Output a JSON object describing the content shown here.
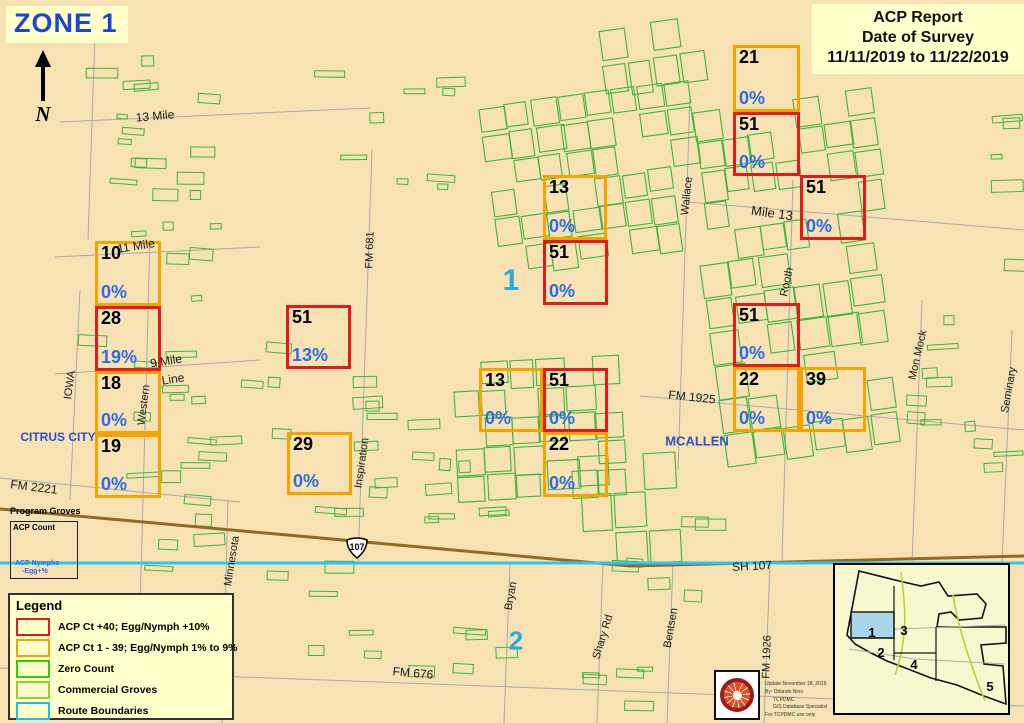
{
  "colors": {
    "map_bg": "#F7E2B4",
    "panel_bg": "#FFFFCC",
    "high": "#E31A1C",
    "moderate": "#F5A300",
    "pct_text": "#2E6BE6",
    "zone_title": "#1C46D0",
    "zone_marker": "#29ABE2",
    "city_text": "#2E50C8",
    "grove_green": "#3DB53D",
    "route_cyan": "#2BC7EF",
    "highway_brown": "#8F6B2A",
    "road_gray": "#A9A9A9"
  },
  "header": {
    "zone_title": "ZONE 1",
    "north_label": "N"
  },
  "report_box": {
    "lines": [
      "ACP Report",
      "Date of Survey",
      "11/11/2019 to 11/22/2019"
    ]
  },
  "squares": [
    {
      "count": "10",
      "pct": "0%",
      "severity": "moderate",
      "x": 95,
      "y": 241,
      "w": 66,
      "h": 65
    },
    {
      "count": "28",
      "pct": "19%",
      "severity": "high",
      "x": 95,
      "y": 306,
      "w": 66,
      "h": 65
    },
    {
      "count": "18",
      "pct": "0%",
      "severity": "moderate",
      "x": 95,
      "y": 371,
      "w": 66,
      "h": 63
    },
    {
      "count": "19",
      "pct": "0%",
      "severity": "moderate",
      "x": 95,
      "y": 434,
      "w": 66,
      "h": 64
    },
    {
      "count": "51",
      "pct": "13%",
      "severity": "high",
      "x": 286,
      "y": 305,
      "w": 65,
      "h": 64
    },
    {
      "count": "29",
      "pct": "0%",
      "severity": "moderate",
      "x": 287,
      "y": 432,
      "w": 65,
      "h": 63
    },
    {
      "count": "13",
      "pct": "0%",
      "severity": "moderate",
      "x": 543,
      "y": 175,
      "w": 64,
      "h": 65
    },
    {
      "count": "51",
      "pct": "0%",
      "severity": "high",
      "x": 543,
      "y": 240,
      "w": 65,
      "h": 65
    },
    {
      "count": "13",
      "pct": "0%",
      "severity": "moderate",
      "x": 479,
      "y": 368,
      "w": 64,
      "h": 64
    },
    {
      "count": "51",
      "pct": "0%",
      "severity": "high",
      "x": 543,
      "y": 368,
      "w": 65,
      "h": 64
    },
    {
      "count": "22",
      "pct": "0%",
      "severity": "moderate",
      "x": 543,
      "y": 432,
      "w": 65,
      "h": 65
    },
    {
      "count": "21",
      "pct": "0%",
      "severity": "moderate",
      "x": 733,
      "y": 45,
      "w": 67,
      "h": 67
    },
    {
      "count": "51",
      "pct": "0%",
      "severity": "high",
      "x": 733,
      "y": 112,
      "w": 67,
      "h": 64
    },
    {
      "count": "51",
      "pct": "0%",
      "severity": "high",
      "x": 800,
      "y": 175,
      "w": 66,
      "h": 65
    },
    {
      "count": "51",
      "pct": "0%",
      "severity": "high",
      "x": 733,
      "y": 303,
      "w": 67,
      "h": 64
    },
    {
      "count": "22",
      "pct": "0%",
      "severity": "moderate",
      "x": 733,
      "y": 367,
      "w": 67,
      "h": 65
    },
    {
      "count": "39",
      "pct": "0%",
      "severity": "moderate",
      "x": 800,
      "y": 367,
      "w": 66,
      "h": 65
    }
  ],
  "road_labels": [
    {
      "text": "13 Mile",
      "x": 155,
      "y": 116,
      "rot": -5,
      "size": 12
    },
    {
      "text": "11 Mile",
      "x": 136,
      "y": 246,
      "rot": -9,
      "size": 12
    },
    {
      "text": "9 Mile",
      "x": 166,
      "y": 361,
      "rot": -9,
      "size": 12
    },
    {
      "text": "Line",
      "x": 173,
      "y": 379,
      "rot": -9,
      "size": 12
    },
    {
      "text": "Western",
      "x": 144,
      "y": 405,
      "rot": -83,
      "size": 11
    },
    {
      "text": "IOWA",
      "x": 70,
      "y": 385,
      "rot": -82,
      "size": 11
    },
    {
      "text": "FM 2221",
      "x": 34,
      "y": 487,
      "rot": 7,
      "size": 12
    },
    {
      "text": "FM 681",
      "x": 370,
      "y": 250,
      "rot": -88,
      "size": 11
    },
    {
      "text": "Inspiration",
      "x": 362,
      "y": 463,
      "rot": -82,
      "size": 11
    },
    {
      "text": "Minnesota",
      "x": 232,
      "y": 561,
      "rot": -81,
      "size": 11
    },
    {
      "text": "SH 107",
      "x": 752,
      "y": 566,
      "rot": -3,
      "size": 12
    },
    {
      "text": "Bryan",
      "x": 511,
      "y": 596,
      "rot": -80,
      "size": 11
    },
    {
      "text": "Shary Rd",
      "x": 603,
      "y": 637,
      "rot": -73,
      "size": 11
    },
    {
      "text": "Bentsen",
      "x": 671,
      "y": 628,
      "rot": -80,
      "size": 11
    },
    {
      "text": "FM 676",
      "x": 413,
      "y": 673,
      "rot": 5,
      "size": 12
    },
    {
      "text": "FM 1926",
      "x": 767,
      "y": 657,
      "rot": -88,
      "size": 11
    },
    {
      "text": "FM 1925",
      "x": 692,
      "y": 397,
      "rot": 6,
      "size": 12
    },
    {
      "text": "Wallace",
      "x": 687,
      "y": 196,
      "rot": -84,
      "size": 11
    },
    {
      "text": "Mile 13",
      "x": 772,
      "y": 213,
      "rot": 8,
      "size": 13
    },
    {
      "text": "Rooth",
      "x": 787,
      "y": 282,
      "rot": -78,
      "size": 11
    },
    {
      "text": "Mon Mock",
      "x": 918,
      "y": 355,
      "rot": -77,
      "size": 11
    },
    {
      "text": "Seminary",
      "x": 1009,
      "y": 390,
      "rot": -80,
      "size": 11
    }
  ],
  "city_labels": [
    {
      "text": "CITRUS CITY",
      "x": 58,
      "y": 437,
      "size": 12
    },
    {
      "text": "MCALLEN",
      "x": 697,
      "y": 441,
      "size": 13
    }
  ],
  "zone_markers": [
    {
      "text": "1",
      "x": 511,
      "y": 281,
      "size": 30
    },
    {
      "text": "2",
      "x": 516,
      "y": 641,
      "size": 26
    }
  ],
  "highway_shield": {
    "text": "107"
  },
  "program_groves": {
    "title": "Program Groves",
    "count_label": "ACP Count",
    "nymph_label_1": "ACP Nymphs",
    "nymph_label_2": "-Egg+%"
  },
  "legend": {
    "title": "Legend",
    "items": [
      {
        "label": "ACP Ct +40; Egg/Nymph +10%",
        "color": "#E31A1C"
      },
      {
        "label": "ACP Ct 1 - 39; Egg/Nymph 1% to 9%",
        "color": "#F5A300"
      },
      {
        "label": "Zero Count",
        "color": "#33CC00"
      },
      {
        "label": "Commercial Groves",
        "color": "#9ACD32"
      },
      {
        "label": "Route Boundaries",
        "color": "#25B8EC"
      }
    ]
  },
  "credits": {
    "lines": [
      "Update November 18, 2019",
      "By: Orlando Nino",
      "TCPDMC",
      "GIS Database Specialist",
      "For TCPDMC use only"
    ]
  },
  "inset": {
    "zone_labels": [
      {
        "text": "1",
        "x": 37,
        "y": 72
      },
      {
        "text": "2",
        "x": 46,
        "y": 92
      },
      {
        "text": "3",
        "x": 69,
        "y": 70
      },
      {
        "text": "4",
        "x": 79,
        "y": 104
      },
      {
        "text": "5",
        "x": 155,
        "y": 126
      }
    ]
  }
}
